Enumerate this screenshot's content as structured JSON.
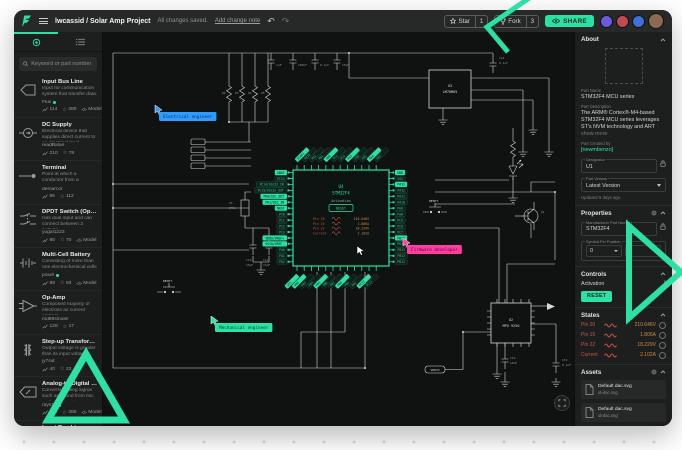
{
  "page": {
    "accent": "#2BE2A4",
    "dot_color": "#dcdcdc"
  },
  "topbar": {
    "project_title": "lwcassid / Solar Amp Project",
    "saved_status": "All changes saved.",
    "add_change_note": "Add change note",
    "undo_glyph": "↶",
    "redo_glyph": "↷",
    "star_label": "Star",
    "star_count": "1",
    "fork_label": "Fork",
    "fork_count": "3",
    "share_label": "SHARE",
    "avatar_colors": [
      "#6a5ae0",
      "#c14953",
      "#3f6fd8",
      "#8a6a52"
    ]
  },
  "sidebar": {
    "search_placeholder": "Keyword or part number",
    "items": [
      {
        "icon": "bus",
        "name": "Input Bus Line",
        "desc": "Input for communication system that transfer data.",
        "author": "Flux",
        "verified": true,
        "views": "114",
        "stars": "380",
        "model": true
      },
      {
        "icon": "dc",
        "name": "DC Supply",
        "desc": "Electrical device that supplies direct current to an electrical load",
        "author": "readBalan",
        "verified": false,
        "views": "210",
        "stars": "78",
        "model": false
      },
      {
        "icon": "terminal",
        "name": "Terminal",
        "desc": "Point at which a conductor from a component comes to an end",
        "author": "demarcor",
        "verified": false,
        "views": "96",
        "stars": "112",
        "model": false
      },
      {
        "icon": "dpdt",
        "name": "DPDT Switch (Open)",
        "desc": "Has dual input and can connect between 2 outputs",
        "author": "yugal1223",
        "verified": false,
        "views": "86",
        "stars": "70",
        "model": true
      },
      {
        "icon": "battery",
        "name": "Multi-Cell Battery",
        "desc": "Consisting of more than one electrochemical cells",
        "author": "poiu9",
        "verified": true,
        "views": "88",
        "stars": "93",
        "model": true
      },
      {
        "icon": "opamp",
        "name": "Op-Amp",
        "desc": "Composed majority of electrons as current carriers.",
        "author": "md89smuler",
        "verified": false,
        "views": "128",
        "stars": "17",
        "model": false
      },
      {
        "icon": "transformer",
        "name": "Step-up Transformer",
        "desc": "Output voltage is greater than its input voltage",
        "author": "jy7sid",
        "verified": false,
        "views": "40",
        "stars": "23",
        "model": false
      },
      {
        "icon": "adc",
        "name": "Analog-to-Digital Converter",
        "desc": "Converts analog signal such as sound from mic to digital signal",
        "author": "rays11",
        "verified": true,
        "views": "114",
        "stars": "380",
        "model": true
      },
      {
        "icon": "bus",
        "name": "Input Bus Line",
        "desc": "Input for communication system that transfer data.",
        "author": "sketchershow",
        "verified": true,
        "views": "114",
        "stars": "380",
        "model": false
      }
    ],
    "model_label": "Model"
  },
  "canvas": {
    "cursors": [
      {
        "label": "Electrical engineer",
        "bg": "#2E9BFF",
        "fg": "#0A2E52",
        "x": 56,
        "y": 80
      },
      {
        "label": "Firmware developer",
        "bg": "#FF3D9E",
        "fg": "#53092E",
        "x": 304,
        "y": 213
      },
      {
        "label": "Mechanical engineer",
        "bg": "#2BE2A4",
        "fg": "#0A3B28",
        "x": 112,
        "y": 291
      }
    ],
    "pointer": {
      "x": 254,
      "y": 214
    },
    "mcu": {
      "ref": "U4",
      "name": "STM32F4",
      "activation_label": "Activation",
      "reset_label": "RESET"
    },
    "left_pins": [
      {
        "t": "VBAT",
        "f": true
      },
      {
        "t": "PC13"
      },
      {
        "t": "PC14/OSC32_IN"
      },
      {
        "t": "PC15/OSC32_OUT"
      },
      {
        "t": "PH0/OSC_OUT",
        "f": true
      },
      {
        "t": "PH1/OSC_IN",
        "f": true
      },
      {
        "t": "NRST",
        "f": true
      },
      {
        "t": "PC0"
      },
      {
        "t": "PC1"
      },
      {
        "t": "PC2"
      },
      {
        "t": "PC3"
      },
      {
        "t": "VDDA/VREF+",
        "f": true
      },
      {
        "t": "VSSA/VREF-",
        "f": true
      },
      {
        "t": "PA0"
      },
      {
        "t": "PA1"
      },
      {
        "t": "PA2"
      }
    ],
    "right_pins": [
      {
        "t": "VDD",
        "f": true
      },
      {
        "t": "VSS"
      },
      {
        "t": "PA13",
        "f": true
      },
      {
        "t": "PA12"
      },
      {
        "t": "PA11"
      },
      {
        "t": "PA10"
      },
      {
        "t": "PA9"
      },
      {
        "t": "PA8"
      },
      {
        "t": "PC9"
      },
      {
        "t": "PC8"
      },
      {
        "t": "PC7"
      },
      {
        "t": "PB15",
        "f": true
      },
      {
        "t": "PB14"
      },
      {
        "t": "PB13"
      },
      {
        "t": "PB12"
      },
      {
        "t": "PB11"
      }
    ],
    "top_pins": [
      {
        "t": "VCAP1",
        "f": true
      },
      {
        "t": "PB10"
      },
      {
        "t": "PB2"
      },
      {
        "t": "PB1"
      },
      {
        "t": "PB0",
        "f": true
      },
      {
        "t": "PC5"
      },
      {
        "t": "PC4"
      },
      {
        "t": "PA7",
        "f": true
      },
      {
        "t": "PA6"
      },
      {
        "t": "PA5"
      },
      {
        "t": "PA4",
        "f": true
      },
      {
        "t": "PA3"
      }
    ],
    "bottom_pins": [
      {
        "t": "VSS",
        "f": true
      },
      {
        "t": "VDD",
        "f": true
      },
      {
        "t": "PB3"
      },
      {
        "t": "PB4"
      },
      {
        "t": "PB5",
        "f": true
      },
      {
        "t": "PB6"
      },
      {
        "t": "PB7"
      },
      {
        "t": "PB8",
        "f": true
      },
      {
        "t": "PB9"
      },
      {
        "t": "PD2"
      },
      {
        "t": "PC12",
        "f": true
      },
      {
        "t": "PC11"
      }
    ],
    "u3": {
      "ref": "U3",
      "name": "LM78M05"
    },
    "u2": {
      "ref": "U2",
      "name": "MPU 9250"
    },
    "net_tag": "VDD33",
    "labels": [
      {
        "t": "1uF",
        "x": 173,
        "y": 34
      },
      {
        "t": "100uF",
        "x": 195,
        "y": 34
      },
      {
        "t": "0.1uF",
        "x": 217,
        "y": 34
      },
      {
        "t": "15pF",
        "x": 239,
        "y": 34
      },
      {
        "t": "R2",
        "x": 119,
        "y": 62
      },
      {
        "t": "R3",
        "x": 132,
        "y": 62
      },
      {
        "t": "R4",
        "x": 145,
        "y": 62
      },
      {
        "t": "R5",
        "x": 158,
        "y": 62
      },
      {
        "t": "C14",
        "x": 396,
        "y": 27
      },
      {
        "t": "0.1uF",
        "x": 396,
        "y": 32
      },
      {
        "t": "X1",
        "x": 126,
        "y": 172
      },
      {
        "t": "8MHz",
        "x": 126,
        "y": 177
      },
      {
        "t": "C10",
        "x": 143,
        "y": 229
      },
      {
        "t": "15pF",
        "x": 143,
        "y": 234
      },
      {
        "t": "C11",
        "x": 160,
        "y": 229
      },
      {
        "t": "15pF",
        "x": 160,
        "y": 234
      },
      {
        "t": "D2",
        "x": 416,
        "y": 133
      },
      {
        "t": "Q1",
        "x": 438,
        "y": 181
      },
      {
        "t": "C19",
        "x": 459,
        "y": 329
      },
      {
        "t": "0.1uF",
        "x": 459,
        "y": 334
      },
      {
        "t": "C16",
        "x": 407,
        "y": 327
      },
      {
        "t": "10uF",
        "x": 407,
        "y": 332
      },
      {
        "t": "RESET",
        "x": 326,
        "y": 170,
        "c": "#d8d8d8"
      },
      {
        "t": "RESET",
        "x": 60,
        "y": 250,
        "c": "#d8d8d8"
      }
    ]
  },
  "states": {
    "title": "States",
    "rows": [
      {
        "name": "Pin 20",
        "value": "210.646V"
      },
      {
        "name": "Pin 15",
        "value": "1.806A"
      },
      {
        "name": "Pin 22",
        "value": "18.229V"
      },
      {
        "name": "Current",
        "value": "2.102A"
      }
    ]
  },
  "inspector": {
    "about": {
      "title": "About",
      "part_name_label": "Part Name",
      "part_name": "STM32F4 MCU series",
      "part_desc_label": "Part Description",
      "part_desc": "The ARM® Cortex®-M4-based STM32F4 MCU series leverages ST's NVM technology and ART",
      "show_more": "show more",
      "created_by_label": "Part Created by",
      "created_by": "[newmbenzo]",
      "designator_label": "Designator",
      "designator_value": "U1",
      "version_label": "Part Version",
      "version_value": "Latest Version",
      "updated": "Updated 5 days ago"
    },
    "properties": {
      "title": "Properties",
      "mpn_label": "Manufacturer Part Number",
      "mpn_value": "STM32F4",
      "pin_pos_label": "Symbol Pin Position",
      "pin_x": "0",
      "pin_y": "0"
    },
    "controls": {
      "title": "Controls",
      "activation_label": "Activation",
      "reset_label": "RESET"
    },
    "assets": {
      "title": "Assets",
      "items": [
        {
          "name": "Default dac.svg",
          "file": "id-dac.svg"
        },
        {
          "name": "Default dac.svg",
          "file": "id-dac.svg"
        }
      ]
    },
    "footer": {
      "caption": "Play states",
      "tabs": [
        {
          "label": "DIAGRAM",
          "active": true
        },
        {
          "label": "CODE",
          "active": false
        }
      ]
    }
  }
}
